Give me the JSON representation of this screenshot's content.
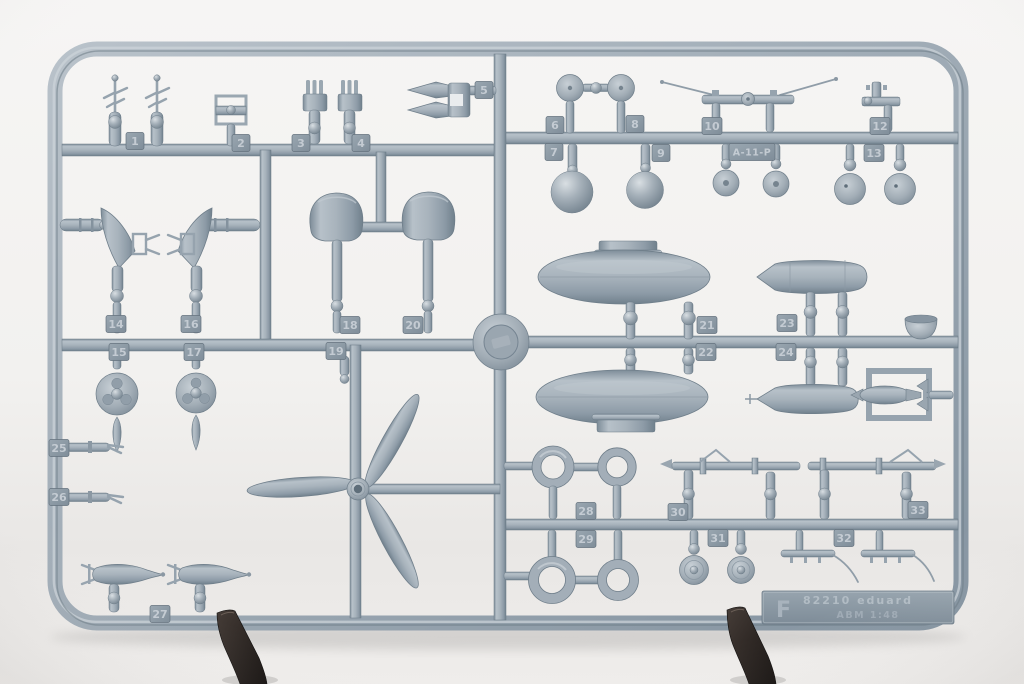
{
  "sprue": {
    "tabs": {
      "t1": "1",
      "t2": "2",
      "t3": "3",
      "t4": "4",
      "t5": "5",
      "t6": "6",
      "t7": "7",
      "t8": "8",
      "t9": "9",
      "t10": "10",
      "t12": "12",
      "t13": "13",
      "t14": "14",
      "t15": "15",
      "t16": "16",
      "t17": "17",
      "t18": "18",
      "t19": "19",
      "t20": "20",
      "t21": "21",
      "t22": "22",
      "t23": "23",
      "t24": "24",
      "t25": "25",
      "t26": "26",
      "t27": "27",
      "t28": "28",
      "t29": "29",
      "t30": "30",
      "t31": "31",
      "t32": "32",
      "t33": "33"
    },
    "part_label": "A-11-P",
    "sprue_letter": "F",
    "plate": {
      "kit_number_line": "82210  eduard",
      "scale_line": "ABM  1:48"
    }
  },
  "colors": {
    "plastic": "#a6b1bb",
    "plastic_dark": "#7c8a96",
    "plastic_light": "#cdd4da",
    "background": "#f4f3f1",
    "clip": "#2e2927"
  }
}
